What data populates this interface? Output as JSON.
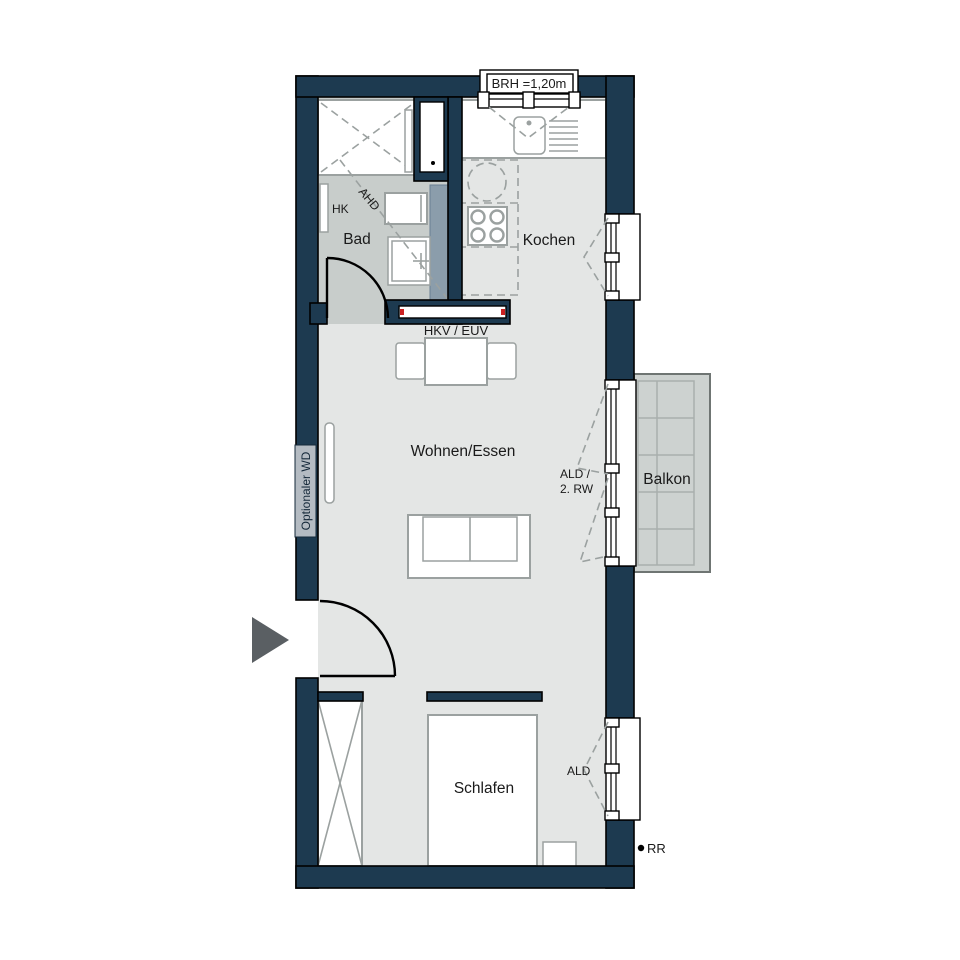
{
  "plan": {
    "title": "apartment-floor-plan",
    "rooms": {
      "bad": "Bad",
      "kochen": "Kochen",
      "wohnen_essen": "Wohnen/Essen",
      "schlafen": "Schlafen",
      "balkon": "Balkon"
    },
    "annotations": {
      "brh": "BRH =1,20m",
      "ahd": "AHD",
      "hk": "HK",
      "hkv_euv": "HKV / EUV",
      "optionaler_wd": "Optionaler WD",
      "ald_rw_line1": "ALD /",
      "ald_rw_line2": "2. RW",
      "ald": "ALD",
      "rr": "RR"
    },
    "colors": {
      "wall": "#1d3a50",
      "floor": "#e4e6e5",
      "bath_floor": "#c8cdcb",
      "balcony_floor": "#cdd2d0",
      "furniture_line": "#9ba1a0",
      "slate_duct": "#8b9dab",
      "marker_red": "#cc2222",
      "entrance_arrow": "#5a5f63"
    }
  }
}
